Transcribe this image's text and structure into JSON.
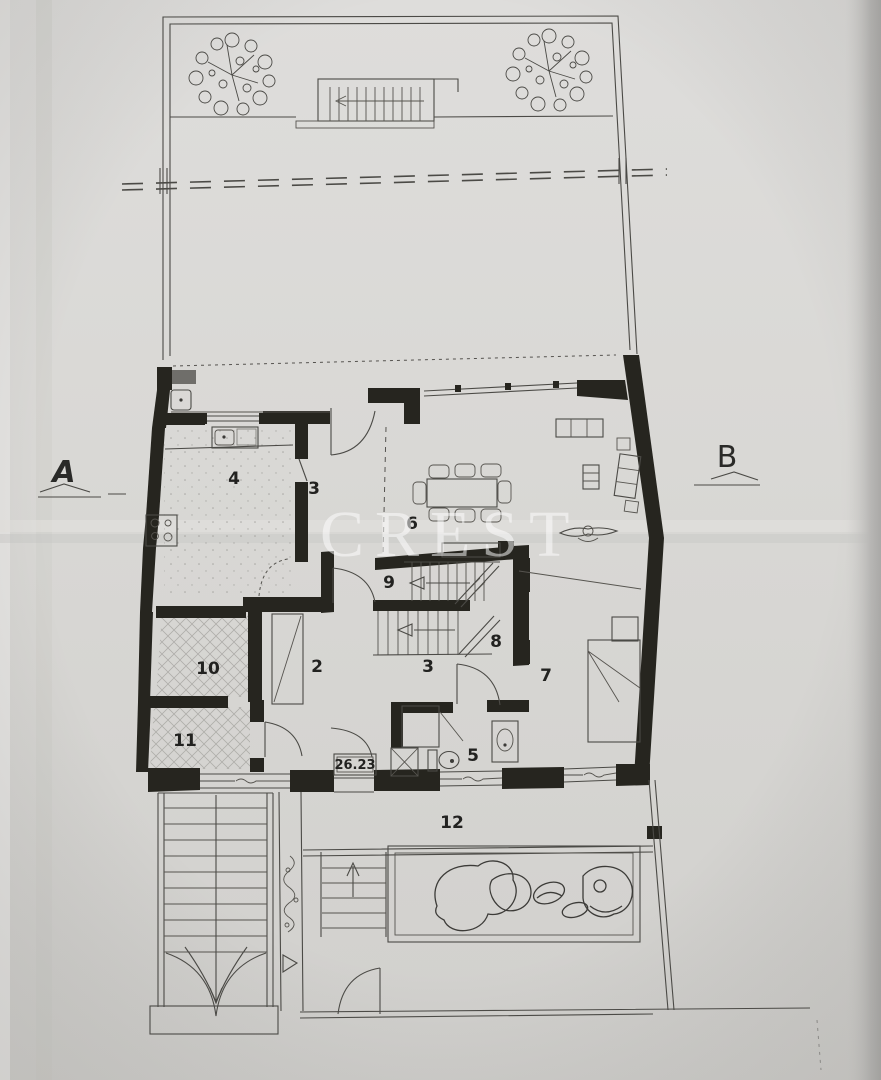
{
  "watermark": {
    "text": "CREST"
  },
  "markers": {
    "section_a": "A",
    "section_b": "B"
  },
  "labels": {
    "area": "26.23"
  },
  "rooms": {
    "hall_upper": "3",
    "kitchen": "4",
    "bathroom": "5",
    "dining": "6",
    "bedroom": "7",
    "stair_mid": "8",
    "lobby": "9",
    "store_upper": "10",
    "store_lower": "11",
    "hall_lower": "2",
    "terrace": "12"
  }
}
